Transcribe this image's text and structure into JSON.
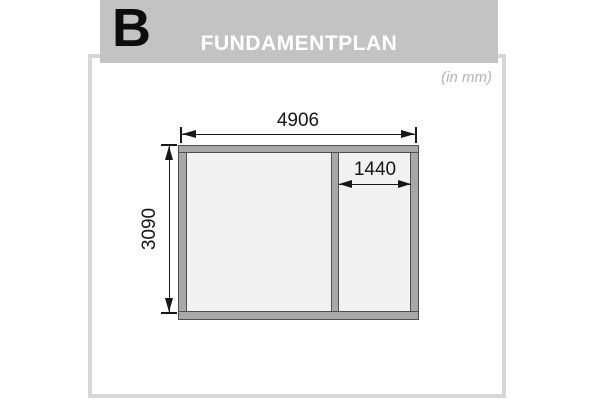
{
  "header": {
    "section_letter": "B",
    "title": "FUNDAMENTPLAN",
    "bg_color": "#c3c3c3",
    "title_color": "#ffffff",
    "letter_color": "#0d0d0d"
  },
  "panel": {
    "unit_note": "(in mm)",
    "border_color": "#d7d7d7",
    "bg_color": "#ffffff"
  },
  "diagram": {
    "type": "foundation-plan",
    "unit": "mm",
    "dimensions": {
      "overall_width": "4906",
      "overall_height": "3090",
      "inner_section_width": "1440"
    },
    "colors": {
      "beam_fill": "#a8a8a8",
      "beam_outline": "#4f4f4f",
      "interior_fill": "#f1f1f1",
      "dimension_color": "#161616"
    }
  }
}
